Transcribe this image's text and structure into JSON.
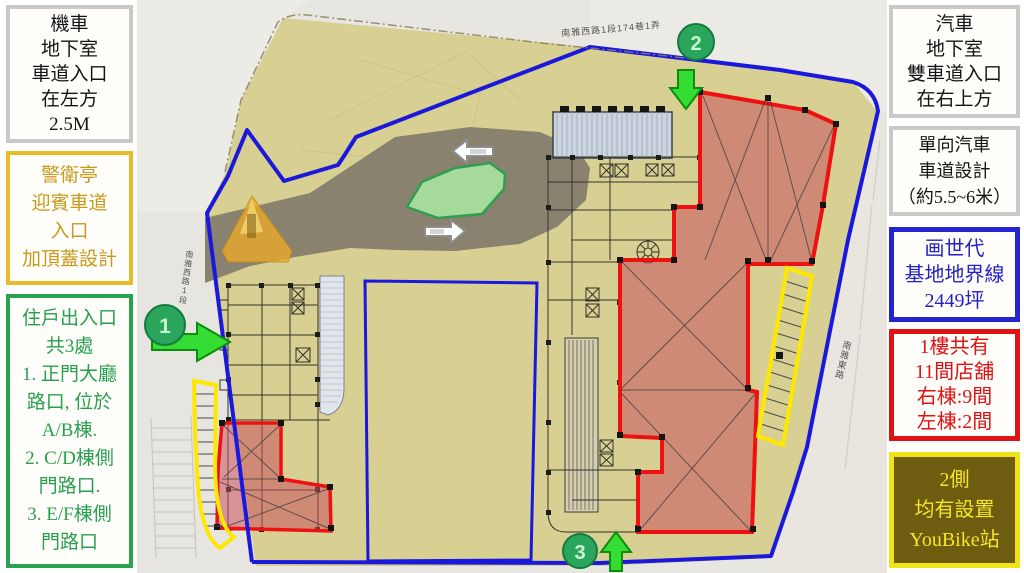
{
  "left_panel": {
    "boxes": [
      {
        "id": "motorcycle-entrance",
        "lines": [
          "機車",
          "地下室",
          "車道入口",
          "在左方",
          "2.5M"
        ],
        "border_color": "#c9c9c9",
        "text_color": "#141414"
      },
      {
        "id": "guard-booth",
        "lines": [
          "警衛亭",
          "迎賓車道",
          "入口",
          "加頂蓋設計"
        ],
        "border_color": "#e8bb2a",
        "text_color": "#c9991b"
      },
      {
        "id": "resident-entrances",
        "lines": [
          "住戶出入口",
          "共3處",
          "1. 正門大廳",
          "路口, 位於",
          "A/B棟.",
          "2. C/D棟側",
          "門路口.",
          "3. E/F棟側",
          "門路口"
        ],
        "border_color": "#2aa351",
        "text_color": "#27a04e"
      }
    ]
  },
  "right_panel": {
    "boxes": [
      {
        "id": "car-entrance",
        "lines": [
          "汽車",
          "地下室",
          "雙車道入口",
          "在右上方"
        ],
        "border_color": "#c9c9c9",
        "text_color": "#141414"
      },
      {
        "id": "lane-width",
        "lines": [
          "單向汽車",
          "車道設計",
          "（約5.5~6米）"
        ],
        "border_color": "#c9c9c9",
        "text_color": "#141414"
      },
      {
        "id": "site-boundary",
        "lines": [
          "画世代",
          "基地地界線",
          "2449坪"
        ],
        "border_color": "#2424d0",
        "text_color": "#2222c8"
      },
      {
        "id": "shops",
        "lines": [
          "1樓共有",
          "11間店舖",
          "右棟:9間",
          "左棟:2間"
        ],
        "border_color": "#e01212",
        "text_color": "#e01212"
      },
      {
        "id": "youbike",
        "lines": [
          "2側",
          "均有設置",
          "YouBike站"
        ],
        "border_color": "#f0e318",
        "text_color": "#f5e62a",
        "bg_color": "#6e5c10"
      }
    ]
  },
  "plan": {
    "street_labels": {
      "top": "南雅西路1段174巷1弄",
      "west": "南雅西路1段",
      "east": "南雅東路"
    },
    "markers": [
      {
        "number": "1"
      },
      {
        "number": "2"
      },
      {
        "number": "3"
      }
    ],
    "colors": {
      "site_fill": "#d8d092",
      "road_fill": "#89826f",
      "boundary_blue": "#1a18dc",
      "building_red": "#ed1111",
      "building_pink_fill": "#c9505c",
      "parking_yellow": "#ffe800",
      "marker_green": "#2aa55c",
      "arrow_green": "#33dd33",
      "island_green": "#a6da9a",
      "canopy_orange": "#e7a92e"
    }
  }
}
